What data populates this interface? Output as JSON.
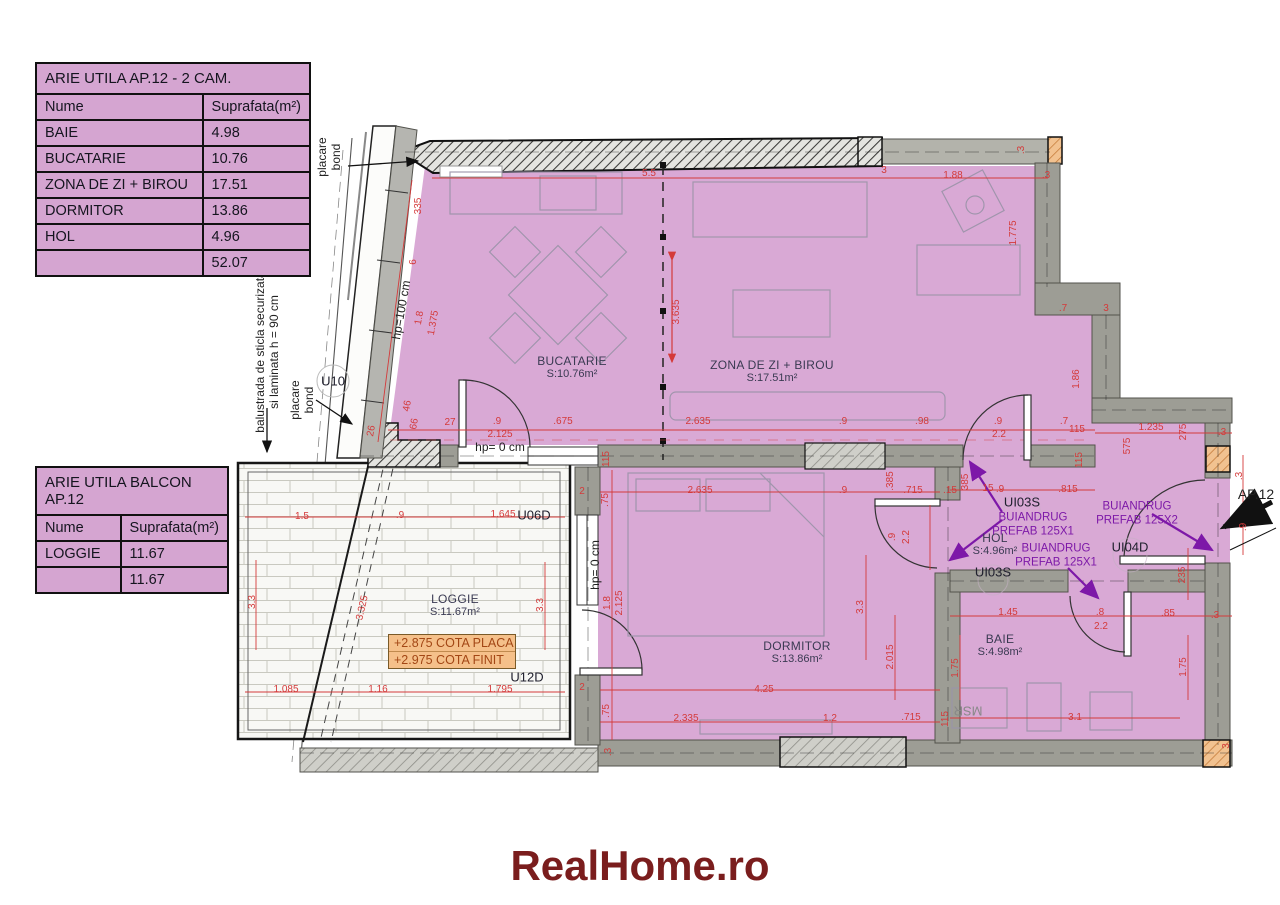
{
  "tables": {
    "apartment": {
      "title": "ARIE UTILA AP.12 - 2 CAM.",
      "headers": {
        "name": "Nume",
        "area": "Suprafata(m²)"
      },
      "rows": [
        {
          "name": "BAIE",
          "area": "4.98"
        },
        {
          "name": "BUCATARIE",
          "area": "10.76"
        },
        {
          "name": "ZONA DE ZI + BIROU",
          "area": "17.51"
        },
        {
          "name": "DORMITOR",
          "area": "13.86"
        },
        {
          "name": "HOL",
          "area": "4.96"
        }
      ],
      "total": "52.07"
    },
    "balcony": {
      "title": "ARIE UTILA BALCON AP.12",
      "headers": {
        "name": "Nume",
        "area": "Suprafata(m²)"
      },
      "rows": [
        {
          "name": "LOGGIE",
          "area": "11.67"
        }
      ],
      "total": "11.67"
    }
  },
  "rooms": [
    {
      "name": "BUCATARIE",
      "area": "S:10.76m²",
      "x": 572,
      "y": 367
    },
    {
      "name": "ZONA DE ZI + BIROU",
      "area": "S:17.51m²",
      "x": 772,
      "y": 371
    },
    {
      "name": "DORMITOR",
      "area": "S:13.86m²",
      "x": 797,
      "y": 652
    },
    {
      "name": "HOL",
      "area": "S:4.96m²",
      "x": 995,
      "y": 544
    },
    {
      "name": "BAIE",
      "area": "S:4.98m²",
      "x": 1000,
      "y": 645
    },
    {
      "name": "LOGGIE",
      "area": "S:11.67m²",
      "x": 455,
      "y": 605
    }
  ],
  "door_labels": [
    {
      "text": "U10",
      "x": 333,
      "y": 381
    },
    {
      "text": "U06D",
      "x": 534,
      "y": 515
    },
    {
      "text": "U12D",
      "x": 527,
      "y": 677
    },
    {
      "text": "UI03S",
      "x": 1022,
      "y": 502
    },
    {
      "text": "UI03S",
      "x": 993,
      "y": 572
    },
    {
      "text": "UI04D",
      "x": 1130,
      "y": 547
    }
  ],
  "lintel_notes": [
    {
      "line1": "BUIANDRUG",
      "line2": "PREFAB 125X1",
      "x": 1033,
      "y": 525
    },
    {
      "line1": "BUIANDRUG",
      "line2": "PREFAB 125X2",
      "x": 1137,
      "y": 514
    },
    {
      "line1": "BUIANDRUG",
      "line2": "PREFAB 125X1",
      "x": 1056,
      "y": 556
    }
  ],
  "annotations": {
    "placare_bond_1": "placare bond",
    "placare_bond_2": "placare bond",
    "balustrade_line1": "balustrada de sticla securizata",
    "balustrade_line2": "si laminata h = 90 cm",
    "hp100": "hp=100 cm",
    "hp0_kitchen": "hp= 0 cm",
    "hp0_bedroom": "hp= 0 cm",
    "msr": "MSR",
    "ap12": "AP.12",
    "cota_placa": "+2.875 COTA PLACA",
    "cota_finit": "+2.975 COTA FINIT"
  },
  "dimensions": [
    {
      "t": "335",
      "x": 419,
      "y": 206,
      "r": -90
    },
    {
      "t": "6",
      "x": 414,
      "y": 262,
      "r": -90
    },
    {
      "t": "1.8",
      "x": 420,
      "y": 318,
      "r": -80
    },
    {
      "t": "1.375",
      "x": 434,
      "y": 323,
      "r": -80
    },
    {
      "t": "5.5",
      "x": 649,
      "y": 174,
      "r": 0
    },
    {
      "t": "3",
      "x": 884,
      "y": 171,
      "r": 0
    },
    {
      "t": "1.88",
      "x": 953,
      "y": 176,
      "r": 0
    },
    {
      "t": ".3",
      "x": 1046,
      "y": 176,
      "r": 0
    },
    {
      "t": ".3",
      "x": 1022,
      "y": 150,
      "r": -90
    },
    {
      "t": "1.775",
      "x": 1014,
      "y": 233,
      "r": -90
    },
    {
      "t": "3.635",
      "x": 677,
      "y": 312,
      "r": -90
    },
    {
      "t": "26",
      "x": 372,
      "y": 431,
      "r": -80
    },
    {
      "t": "46",
      "x": 408,
      "y": 406,
      "r": -80
    },
    {
      "t": "66",
      "x": 415,
      "y": 424,
      "r": -80
    },
    {
      "t": "27",
      "x": 450,
      "y": 423,
      "r": 0
    },
    {
      "t": ".9",
      "x": 497,
      "y": 422,
      "r": 0
    },
    {
      "t": "2.125",
      "x": 500,
      "y": 435,
      "r": 0
    },
    {
      "t": ".675",
      "x": 563,
      "y": 422,
      "r": 0
    },
    {
      "t": "2.635",
      "x": 698,
      "y": 422,
      "r": 0
    },
    {
      "t": ".9",
      "x": 843,
      "y": 422,
      "r": 0
    },
    {
      "t": ".98",
      "x": 922,
      "y": 422,
      "r": 0
    },
    {
      "t": ".9",
      "x": 998,
      "y": 422,
      "r": 0
    },
    {
      "t": "2.2",
      "x": 999,
      "y": 435,
      "r": 0
    },
    {
      "t": ".7",
      "x": 1064,
      "y": 422,
      "r": 0
    },
    {
      "t": ".7",
      "x": 1063,
      "y": 309,
      "r": 0
    },
    {
      "t": "3",
      "x": 1106,
      "y": 309,
      "r": 0
    },
    {
      "t": "1.86",
      "x": 1077,
      "y": 379,
      "r": -90
    },
    {
      "t": "115",
      "x": 1077,
      "y": 430,
      "r": 0
    },
    {
      "t": "1.235",
      "x": 1151,
      "y": 428,
      "r": 0
    },
    {
      "t": "275",
      "x": 1184,
      "y": 432,
      "r": -90
    },
    {
      "t": ".3",
      "x": 1222,
      "y": 433,
      "r": 0
    },
    {
      "t": "575",
      "x": 1128,
      "y": 446,
      "r": -90
    },
    {
      "t": "15",
      "x": 988,
      "y": 489,
      "r": 0
    },
    {
      "t": "385",
      "x": 966,
      "y": 482,
      "r": -90
    },
    {
      "t": ".9",
      "x": 1000,
      "y": 490,
      "r": 0
    },
    {
      "t": ".815",
      "x": 1068,
      "y": 490,
      "r": 0
    },
    {
      "t": "115",
      "x": 1080,
      "y": 460,
      "r": -90
    },
    {
      "t": "2.635",
      "x": 700,
      "y": 491,
      "r": 0
    },
    {
      "t": ".9",
      "x": 843,
      "y": 491,
      "r": 0
    },
    {
      "t": ".385",
      "x": 891,
      "y": 481,
      "r": -90
    },
    {
      "t": ".715",
      "x": 913,
      "y": 491,
      "r": 0
    },
    {
      "t": ".15",
      "x": 950,
      "y": 491,
      "r": 0
    },
    {
      "t": "2",
      "x": 582,
      "y": 492,
      "r": 0
    },
    {
      "t": ".75",
      "x": 606,
      "y": 500,
      "r": -90
    },
    {
      "t": "115",
      "x": 607,
      "y": 459,
      "r": -90
    },
    {
      "t": "1.8",
      "x": 608,
      "y": 603,
      "r": -90
    },
    {
      "t": "2.125",
      "x": 620,
      "y": 603,
      "r": -90
    },
    {
      "t": ".9",
      "x": 893,
      "y": 537,
      "r": -90
    },
    {
      "t": "2.2",
      "x": 907,
      "y": 537,
      "r": -90
    },
    {
      "t": "3.3",
      "x": 861,
      "y": 607,
      "r": -90
    },
    {
      "t": "2.015",
      "x": 891,
      "y": 657,
      "r": -90
    },
    {
      "t": "4.25",
      "x": 764,
      "y": 690,
      "r": 0
    },
    {
      "t": "2.335",
      "x": 686,
      "y": 719,
      "r": 0
    },
    {
      "t": "1.2",
      "x": 830,
      "y": 719,
      "r": 0
    },
    {
      "t": ".715",
      "x": 911,
      "y": 718,
      "r": 0
    },
    {
      "t": "115",
      "x": 946,
      "y": 719,
      "r": -90
    },
    {
      "t": ".75",
      "x": 607,
      "y": 711,
      "r": -90
    },
    {
      "t": ".3",
      "x": 609,
      "y": 752,
      "r": -90
    },
    {
      "t": "2",
      "x": 582,
      "y": 688,
      "r": 0
    },
    {
      "t": "235",
      "x": 1183,
      "y": 575,
      "r": -90
    },
    {
      "t": "1.45",
      "x": 1008,
      "y": 613,
      "r": 0
    },
    {
      "t": ".8",
      "x": 1100,
      "y": 613,
      "r": 0
    },
    {
      "t": "2.2",
      "x": 1101,
      "y": 627,
      "r": 0
    },
    {
      "t": ".85",
      "x": 1168,
      "y": 614,
      "r": 0
    },
    {
      "t": ".3",
      "x": 1215,
      "y": 616,
      "r": 0
    },
    {
      "t": "1.75",
      "x": 956,
      "y": 668,
      "r": -90
    },
    {
      "t": "1.75",
      "x": 1184,
      "y": 667,
      "r": -90
    },
    {
      "t": "3.1",
      "x": 1075,
      "y": 718,
      "r": 0
    },
    {
      "t": "1.5",
      "x": 302,
      "y": 517,
      "r": 0
    },
    {
      "t": ".9",
      "x": 400,
      "y": 516,
      "r": 0
    },
    {
      "t": "1.645",
      "x": 503,
      "y": 515,
      "r": 0
    },
    {
      "t": "3.3",
      "x": 253,
      "y": 602,
      "r": -90
    },
    {
      "t": "3.325",
      "x": 363,
      "y": 608,
      "r": -77
    },
    {
      "t": "3.3",
      "x": 541,
      "y": 605,
      "r": -90
    },
    {
      "t": "1.085",
      "x": 286,
      "y": 690,
      "r": 0
    },
    {
      "t": "1.16",
      "x": 378,
      "y": 690,
      "r": 0
    },
    {
      "t": "1.795",
      "x": 500,
      "y": 690,
      "r": 0
    },
    {
      "t": ".3",
      "x": 1240,
      "y": 476,
      "r": -90
    },
    {
      "t": ".9",
      "x": 1244,
      "y": 527,
      "r": -90
    },
    {
      "t": "3",
      "x": 1227,
      "y": 746,
      "r": -90
    }
  ],
  "logo": "RealHome.ro",
  "colors": {
    "room_fill": "#d9a9d5",
    "table_fill": "#d5a5d1",
    "dim_red": "#d43a3a",
    "note_purple": "#7d18a8",
    "logo_maroon": "#7a1d1d",
    "wall_gray": "#9d9d95",
    "cota_bg": "#f5c08a"
  }
}
